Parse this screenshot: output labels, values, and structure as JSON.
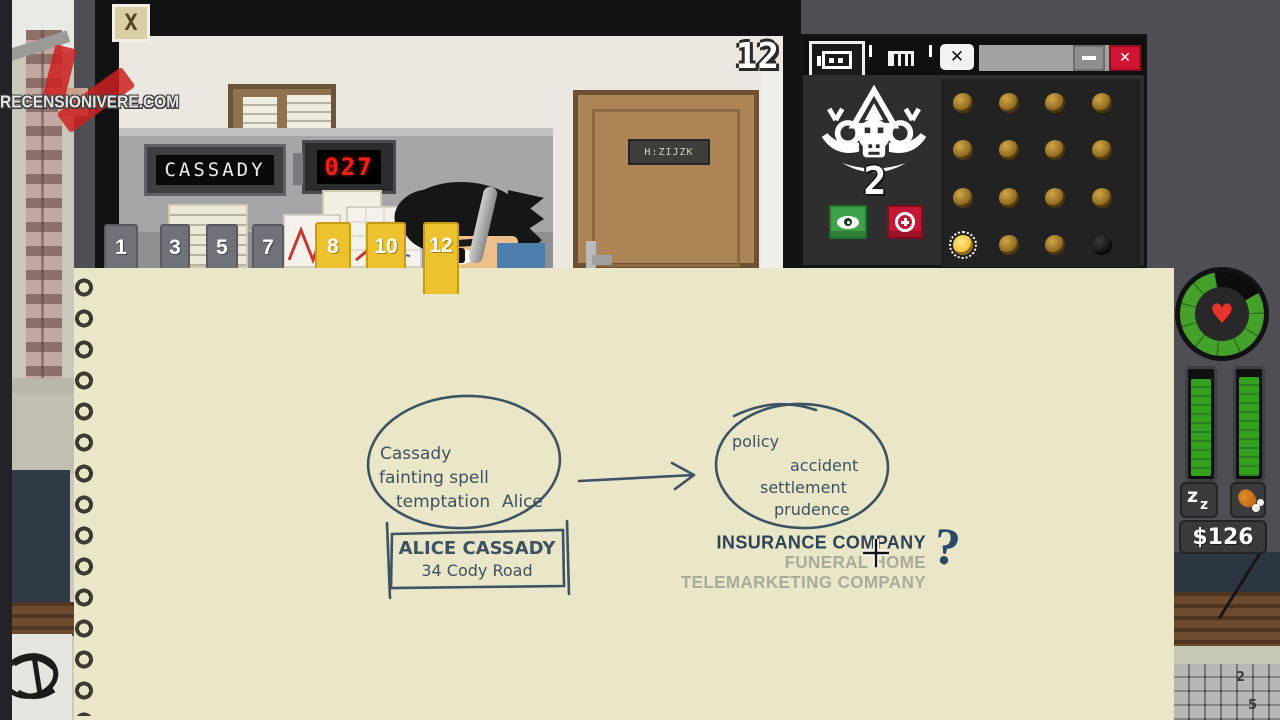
{
  "watermark": {
    "site_text": "RECENSIONIVERE.COM"
  },
  "cam": {
    "close_glyph": "X",
    "cage_number": "12",
    "name_display": "CASSADY",
    "counter_value": "027",
    "door_sign": "H:ZIJZK",
    "tabs": [
      {
        "label": "1"
      },
      {
        "label": "3"
      },
      {
        "label": "5"
      },
      {
        "label": "7"
      },
      {
        "label": "8"
      },
      {
        "label": "10"
      },
      {
        "label": "12"
      }
    ]
  },
  "club": {
    "tab_icons": [
      "cage-icon",
      "cage-small-icon",
      "close-icon"
    ],
    "window_controls": [
      "minimize-icon",
      "close-icon"
    ],
    "monkey_count": "2",
    "action_buttons": [
      "eye-icon",
      "plus-icon"
    ],
    "coins": [
      "gold",
      "gold",
      "gold",
      "gold",
      "gold",
      "gold",
      "gold",
      "gold",
      "gold",
      "gold",
      "gold",
      "gold",
      "selected",
      "gold",
      "gold",
      "black"
    ],
    "accent_green": "#3fa24a",
    "accent_red": "#c21836"
  },
  "hud": {
    "heart_icon": "♥",
    "sleep_z_big": "z",
    "sleep_z_small": "z",
    "money": "$126"
  },
  "notepad": {
    "ink_color": "#3d5263",
    "faded_color": "#a9ac9a",
    "group1": {
      "w1": "Cassady",
      "w2": "fainting spell",
      "w3": "temptation",
      "w4": "Alice",
      "answer1": "ALICE CASSADY",
      "answer2": "34 Cody Road"
    },
    "group2": {
      "w1": "policy",
      "w2": "accident",
      "w3": "settlement",
      "w4": "prudence",
      "opt1": "INSURANCE COMPANY",
      "opt2": "FUNERAL HOME",
      "opt3": "TELEMARKETING COMPANY",
      "question": "?"
    }
  },
  "desk": {
    "key1": "2",
    "key2": "5"
  }
}
